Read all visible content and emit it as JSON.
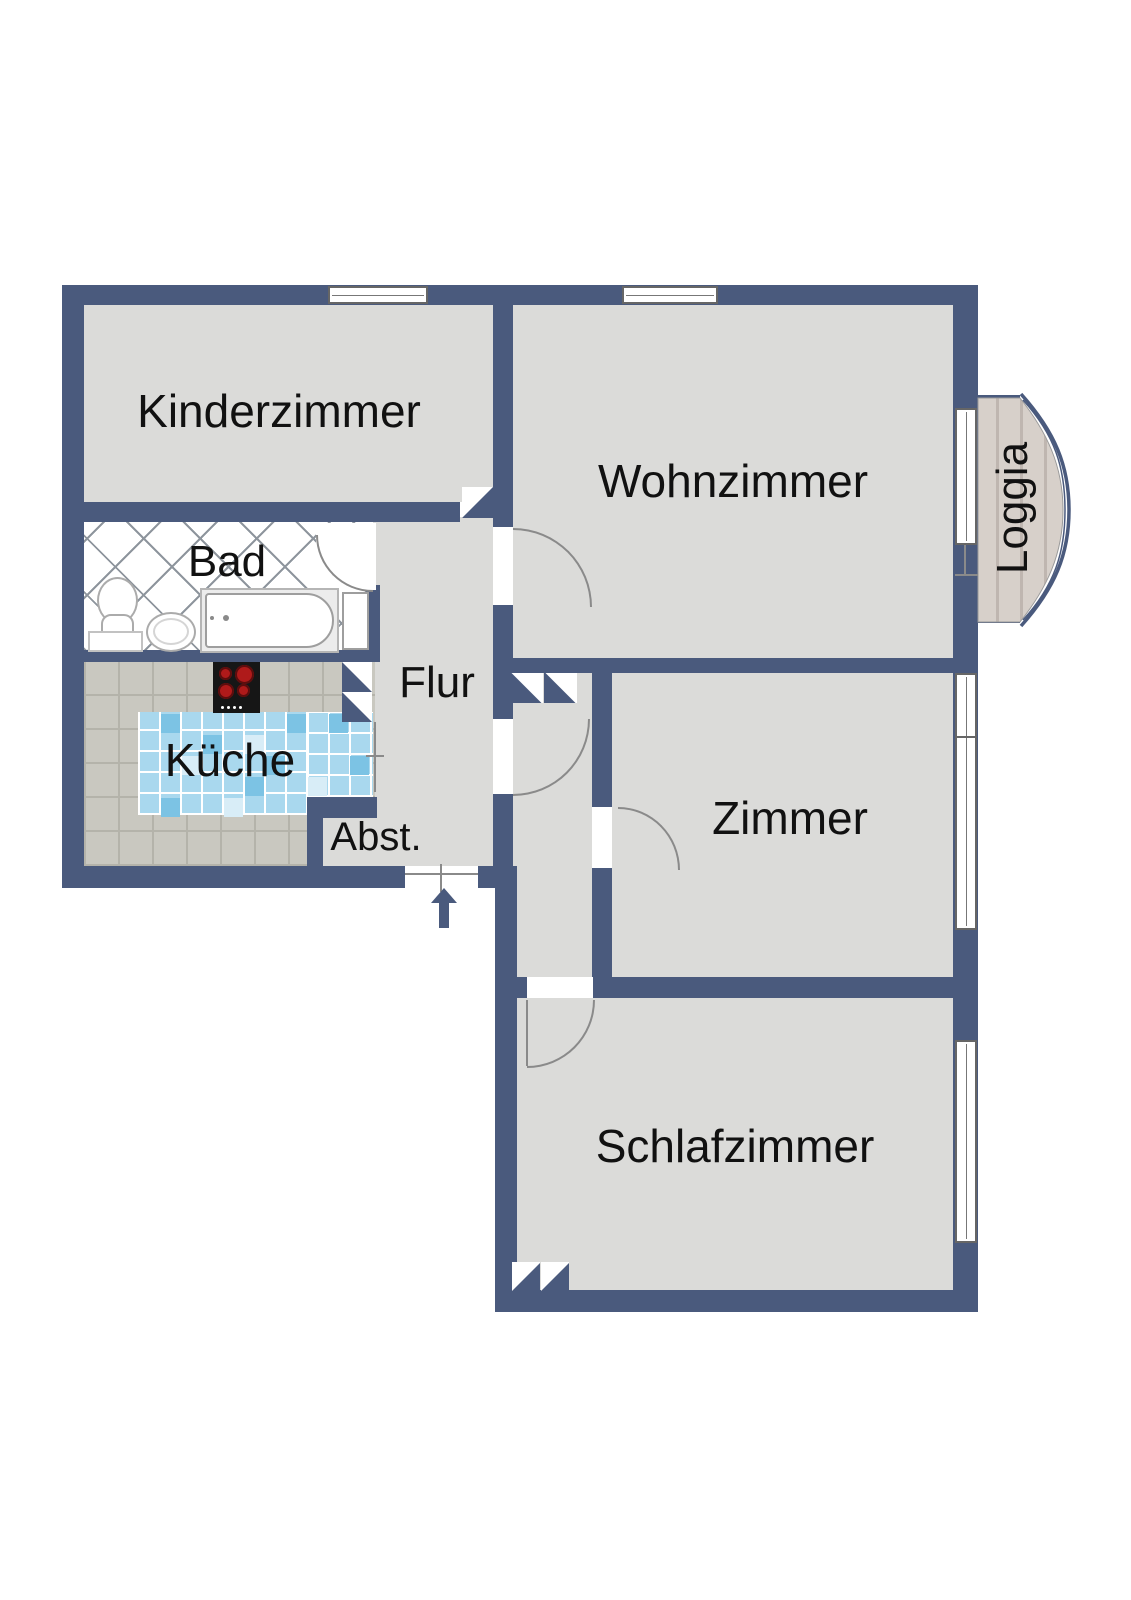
{
  "floorplan": {
    "rooms": {
      "kinderzimmer": {
        "label": "Kinderzimmer"
      },
      "wohnzimmer": {
        "label": "Wohnzimmer"
      },
      "loggia": {
        "label": "Loggia"
      },
      "bad": {
        "label": "Bad"
      },
      "flur": {
        "label": "Flur"
      },
      "kueche": {
        "label": "Küche"
      },
      "abstellraum": {
        "label": "Abst."
      },
      "zimmer": {
        "label": "Zimmer"
      },
      "schlafzimmer": {
        "label": "Schlafzimmer"
      }
    },
    "colors": {
      "wall": "#4A5A7D",
      "floor": "#DBDBD9",
      "badline": "#8E959D",
      "tile": "#C9C8C0",
      "tileline": "#B4B3AA",
      "mosaic": "#A9D8EE",
      "wood": "#D7D0CA",
      "woodline": "#BFB6B0",
      "doorline": "#8A8A8A",
      "burner": "#AF1A1A",
      "stove": "#161616",
      "label": "#111111"
    },
    "icons": {
      "entrance_arrow": "up-arrow",
      "stove": "four-burner-cooktop",
      "toilet": "toilet",
      "sink": "washbasin",
      "bathtub": "bathtub"
    }
  }
}
